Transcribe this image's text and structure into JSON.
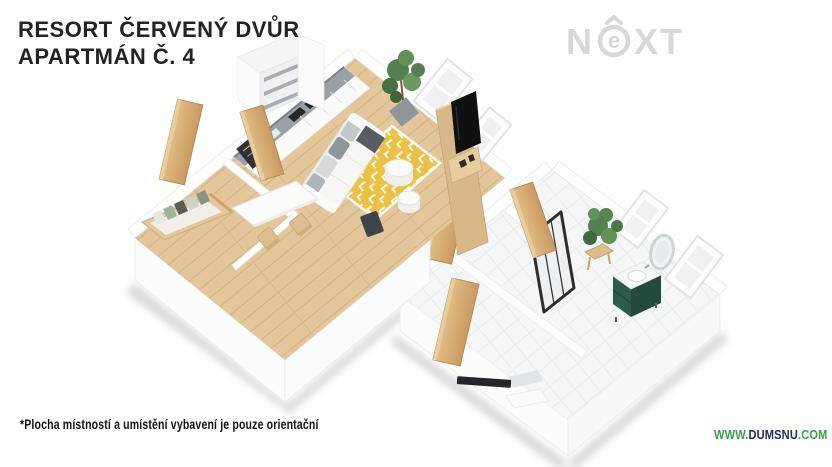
{
  "header": {
    "title_line1": "RESORT ČERVENÝ DVŮR",
    "title_line2": "APARTMÁN Č. 4"
  },
  "logo": {
    "letter_n": "N",
    "letter_e": "e",
    "letters_xt": "XT",
    "color": "#d8d8d8"
  },
  "footer": {
    "disclaimer": "*Plocha místností a umístění vybavení je pouze orientační"
  },
  "watermark": {
    "prefix": "WWW.",
    "name": "DUMSNU",
    "suffix": ".COM",
    "green": "#35a24c",
    "navy": "#1f2a68"
  },
  "floorplan": {
    "colors": {
      "wood_floor": "#e3c79b",
      "tile_floor": "#f5f6f7",
      "rug_yellow": "#ecc043",
      "sofa_white": "#f6f6f4",
      "vanity_green": "#2d5c4c",
      "vanity_green_dark": "#24493d",
      "tv_black": "#101010",
      "door_wood": "#cfa468",
      "furniture_wood": "#d9b887",
      "plant_green": "#54804f",
      "counter_gray": "#9aa1a6",
      "shower_frame": "#2d2d2d",
      "wall_white": "#ffffff"
    }
  }
}
